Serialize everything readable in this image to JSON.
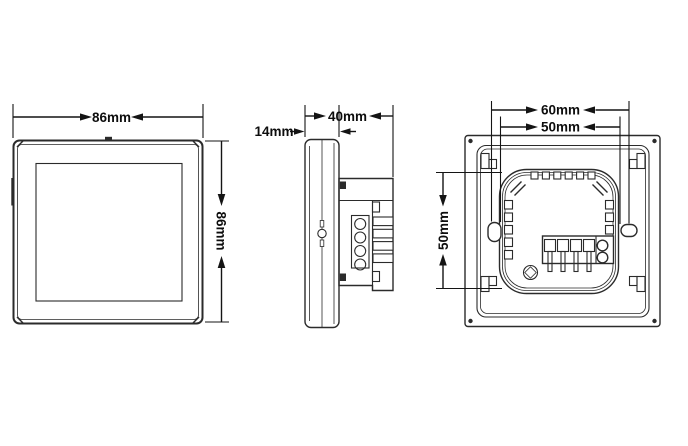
{
  "page": {
    "background": "#ffffff",
    "line_color": "#2b2b2b",
    "dim_color": "#141414"
  },
  "views": {
    "front": {
      "dim_width": "86mm",
      "dim_height": "86mm"
    },
    "side": {
      "dim_panel_depth": "14mm",
      "dim_total_depth": "40mm"
    },
    "back": {
      "dim_hole_spacing": "60mm",
      "dim_top_width": "50mm",
      "dim_left_height": "50mm"
    }
  }
}
